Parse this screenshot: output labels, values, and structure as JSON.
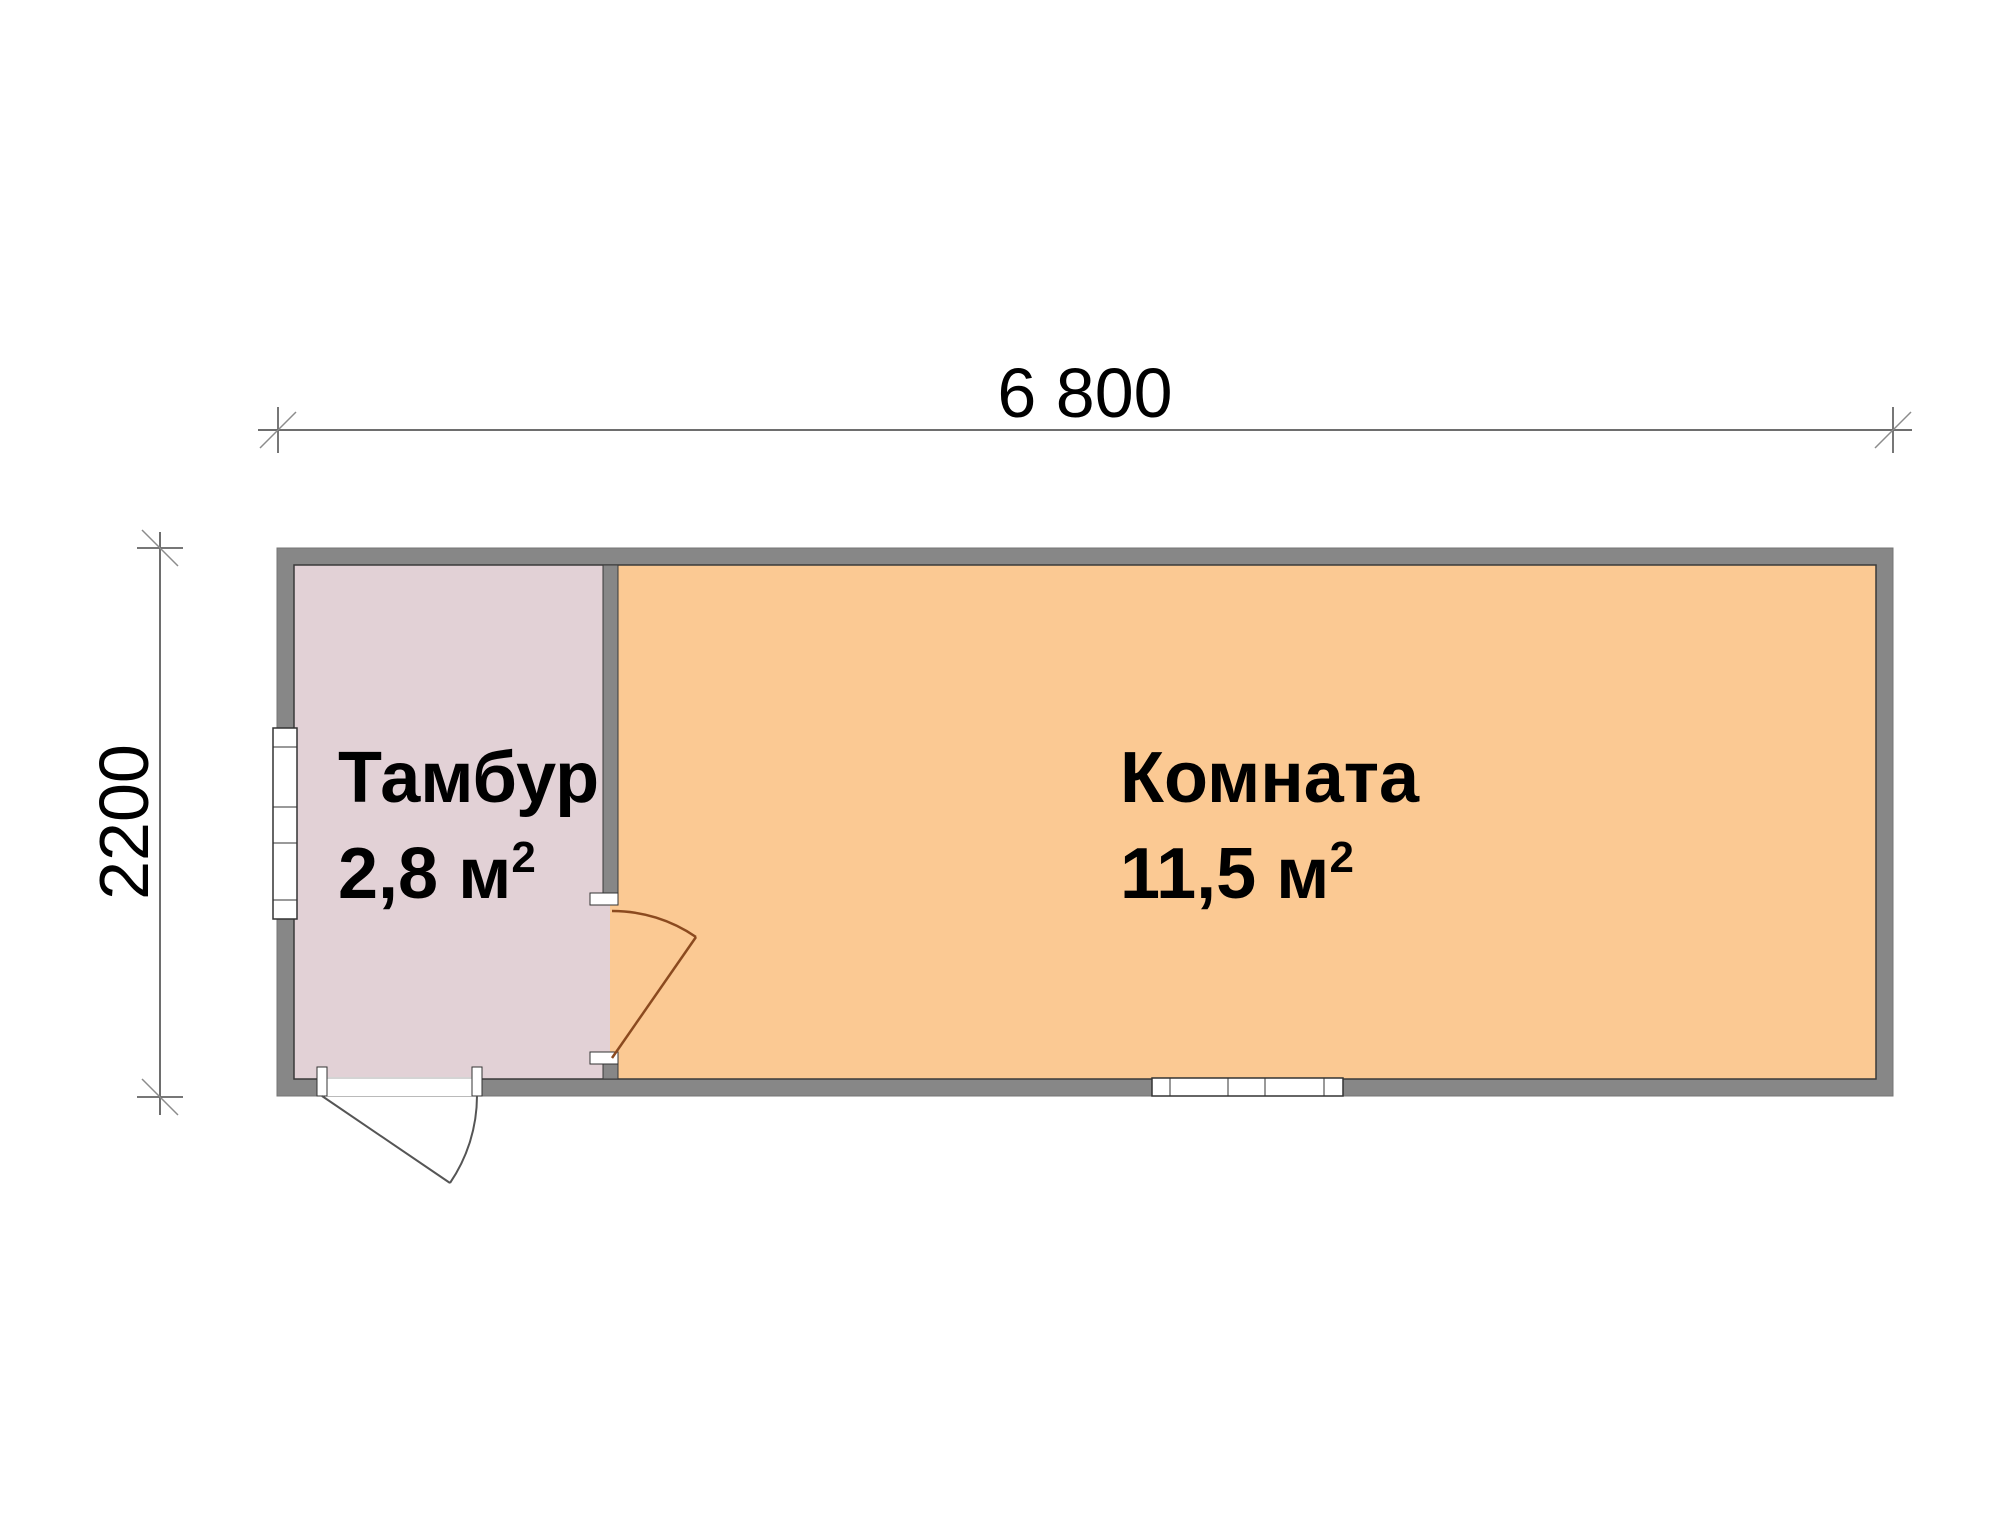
{
  "floor_plan": {
    "dimension_width": {
      "label": "6 800"
    },
    "dimension_height": {
      "label": "2200"
    },
    "rooms": [
      {
        "name": "Тамбур",
        "area": "2,8 м",
        "area_superscript": "2"
      },
      {
        "name": "Комната",
        "area": "11,5 м",
        "area_superscript": "2"
      }
    ],
    "colors": {
      "background": "#ffffff",
      "wall": "#878787",
      "wall_outline": "#3a3a3a",
      "room_tambur": "#e2d1d6",
      "room_komnata": "#fbc993",
      "interior_door": "#8b4a1f",
      "exterior_door": "#555555",
      "dimension_line": "#6e6e6e",
      "text": "#000000"
    }
  }
}
